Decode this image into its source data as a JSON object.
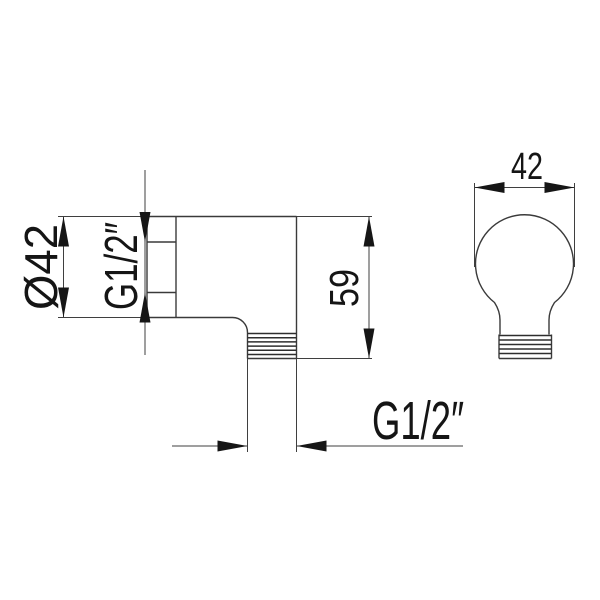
{
  "drawing": {
    "kind": "technical-drawing",
    "part": "shower-outlet-elbow",
    "colors": {
      "background": "#ffffff",
      "line": "#3f3f3f",
      "ink": "#151515"
    },
    "views": {
      "side_view": {
        "labels": {
          "flange_diameter": "Ø42",
          "inlet_thread": "G1/2″",
          "overall_height": "59",
          "outlet_thread": "G1/2″"
        }
      },
      "front_view": {
        "labels": {
          "width": "42"
        }
      }
    }
  }
}
